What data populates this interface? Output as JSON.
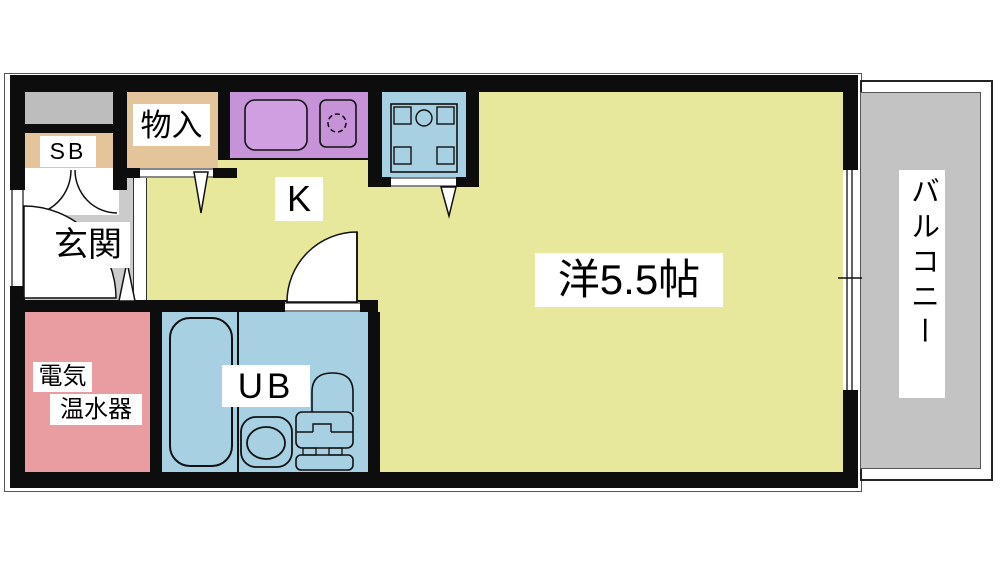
{
  "plan_title": "apartment-floor-plan",
  "rooms": {
    "shoe_box": {
      "label": "SB"
    },
    "storage": {
      "label": "物入"
    },
    "kitchen": {
      "label": "K"
    },
    "entrance": {
      "label": "玄関"
    },
    "water_heater": {
      "label": "電気温水器",
      "line1": "電気",
      "line2": "温水器"
    },
    "unit_bath": {
      "label": "UB"
    },
    "main_room": {
      "label": "洋5.5帖"
    },
    "balcony": {
      "label": "バルコニー"
    }
  },
  "colors": {
    "wall": "#0d0d0d",
    "room_yellow": "#e7e89b",
    "kitchen_purple": "#c692d8",
    "sink_purple": "#cf9fe2",
    "water_blue": "#a7d0e2",
    "heater_pink": "#e99da1",
    "closet_tan": "#e4c59b",
    "entrance_gray": "#cbcbcb",
    "balcony_gray": "#c3c3c3",
    "shelf_gray": "#bdbdbd"
  }
}
